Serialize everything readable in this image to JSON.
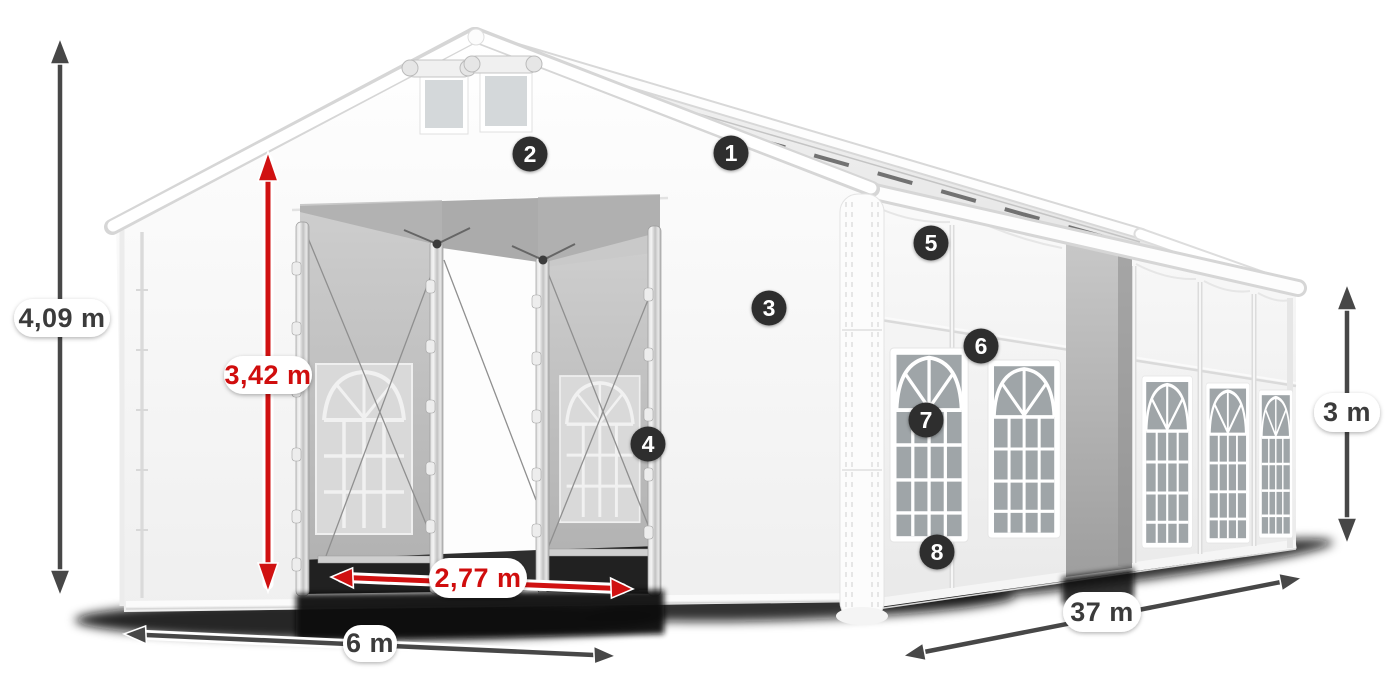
{
  "diagram": {
    "subject": "White marquee tent with dimension arrows and numbered feature callouts",
    "measurements": {
      "total_height": {
        "label": "4,09 m"
      },
      "entrance_height": {
        "label": "3,42 m"
      },
      "entrance_width": {
        "label": "2,77 m"
      },
      "front_width": {
        "label": "6 m"
      },
      "side_length": {
        "label": "37 m"
      },
      "wall_height": {
        "label": "3 m"
      }
    },
    "callouts": [
      {
        "number": "1"
      },
      {
        "number": "2"
      },
      {
        "number": "3"
      },
      {
        "number": "4"
      },
      {
        "number": "5"
      },
      {
        "number": "6"
      },
      {
        "number": "7"
      },
      {
        "number": "8"
      }
    ],
    "colors": {
      "dimension_dark": "#474747",
      "dimension_red": "#d01111",
      "label_background": "#ffffff",
      "label_text_dark": "#3a3a3a",
      "callout_background": "#2e2e2e",
      "callout_text": "#ffffff"
    }
  }
}
